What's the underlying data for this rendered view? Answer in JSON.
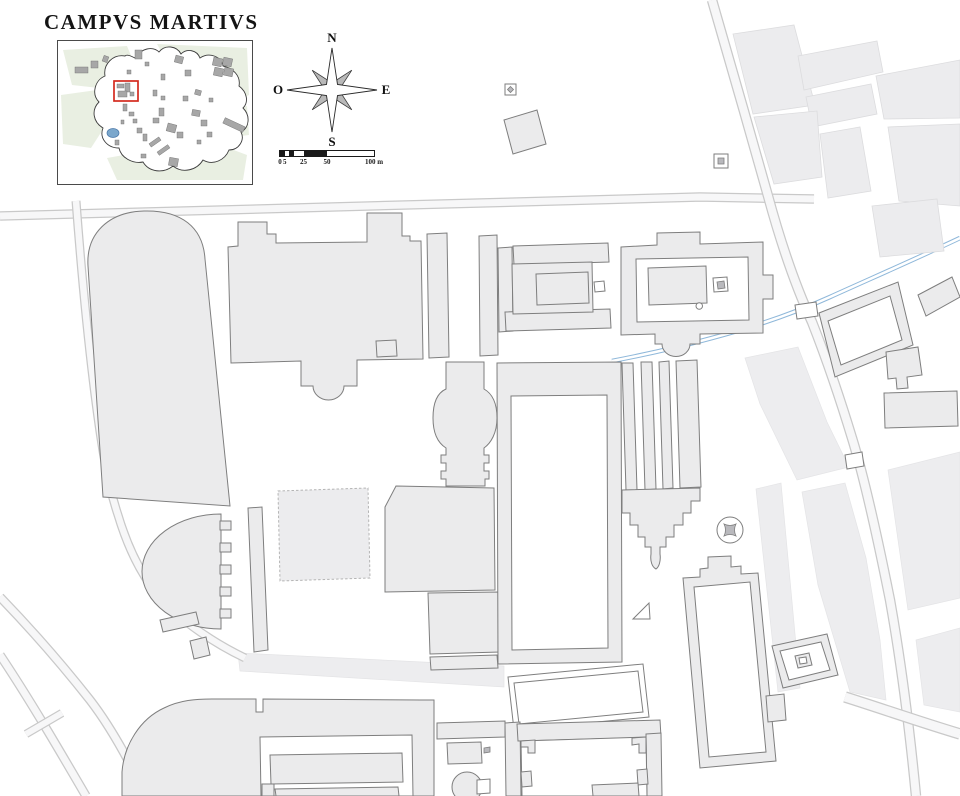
{
  "title": "CAMPVS MARTIVS",
  "compass": {
    "n": "N",
    "w": "O",
    "e": "E",
    "s": "S"
  },
  "scalebar": {
    "px_per_m": 0.94,
    "ticks": [
      {
        "m": 0,
        "t": "0"
      },
      {
        "m": 5,
        "t": "5"
      },
      {
        "m": 25,
        "t": "25"
      },
      {
        "m": 50,
        "t": "50"
      },
      {
        "m": 100,
        "t": "100 m"
      }
    ],
    "segments": [
      {
        "a": 0,
        "b": 5,
        "dark": true
      },
      {
        "a": 5,
        "b": 10,
        "dark": false
      },
      {
        "a": 10,
        "b": 15,
        "dark": true
      },
      {
        "a": 15,
        "b": 25,
        "dark": false
      },
      {
        "a": 25,
        "b": 50,
        "dark": true
      },
      {
        "a": 50,
        "b": 100,
        "dark": false
      }
    ]
  },
  "colors": {
    "ink": "#1a1a1a",
    "building_fill": "#ebebec",
    "building_stroke": "#7e7e7e",
    "block_fill": "#ececee",
    "block_stroke": "#dcdcde",
    "light_fill": "#ededef",
    "light_stroke": "#e4e4e6",
    "road_casing": "#c9c9c9",
    "road_fill": "#f7f7f8",
    "aqueduct_blue": "#8fb8da",
    "ruin_stroke": "#b4b4b4",
    "monument_gray": "#b9b9bd",
    "inset_green": "#e9efe2",
    "inset_building": "#a7a7a7",
    "inset_water": "#7ba7cc",
    "highlight_red": "#d42a1e"
  },
  "map": {
    "light": [
      {
        "n": "light-band-south-of-theater",
        "d": "M238,653 L504,666 L504,687 L240,671 Z"
      },
      {
        "n": "light-band-via-lata-south",
        "d": "M756,489 L781,483 L800,688 L778,692 Z"
      },
      {
        "n": "light-block-east-1",
        "d": "M745,358 L798,347 L827,422 L849,467 L797,480 L760,404 Z"
      },
      {
        "n": "light-block-east-2",
        "d": "M802,492 L845,483 L866,558 L880,640 L886,700 L850,692 L818,585 Z"
      },
      {
        "n": "light-block-east-3",
        "d": "M888,470 L960,452 L960,598 L908,610 Z"
      },
      {
        "n": "light-block-east-4",
        "d": "M916,640 L960,628 L960,712 L924,705 Z"
      }
    ],
    "roads": [
      {
        "n": "road-main-east-west",
        "w": 7,
        "d": "M0,216 L480,203 L700,197 L814,199"
      },
      {
        "n": "road-west-north-south",
        "w": 6.5,
        "d": "M76,201 C82,280 88,340 95,395 C102,450 108,485 118,515 C130,555 148,588 172,610 C195,630 220,646 245,658"
      },
      {
        "n": "road-southwest-a",
        "w": 7,
        "d": "M0,597 C30,628 60,662 90,700 C110,726 128,758 146,796"
      },
      {
        "n": "road-southwest-b",
        "w": 7,
        "d": "M0,655 C30,700 58,748 86,796"
      },
      {
        "n": "road-southwest-link",
        "w": 6,
        "d": "M26,734 L62,713"
      },
      {
        "n": "road-northeast-diagonal",
        "w": 8,
        "d": "M712,0 C730,62 750,132 768,196 C780,240 795,285 812,322 C825,355 838,392 852,438 C865,480 878,540 890,600 C898,645 908,712 916,796"
      },
      {
        "n": "road-southeast",
        "w": 9,
        "d": "M845,697 C880,708 920,722 960,734"
      }
    ],
    "aqueduct": {
      "n": "aqua-virgo-aqueduct",
      "d": "M960,238 C920,257 872,278 830,297 C788,316 750,328 712,338 C672,349 638,356 612,361"
    },
    "shapes": [
      {
        "n": "city-block-ne-1",
        "c": "blk",
        "d": "M733,34 L794,25 L815,105 L753,114 Z"
      },
      {
        "n": "city-block-ne-2",
        "c": "blk",
        "d": "M798,56 L877,41 L883,72 L804,90 Z"
      },
      {
        "n": "city-block-ne-3",
        "c": "blk",
        "d": "M806,97 L871,84 L877,114 L812,127 Z"
      },
      {
        "n": "city-block-ne-4",
        "c": "blk",
        "d": "M754,117 L817,111 L822,177 L774,184 Z"
      },
      {
        "n": "city-block-ne-5",
        "c": "blk",
        "d": "M820,134 L860,127 L871,191 L828,198 Z"
      },
      {
        "n": "city-block-ne-6",
        "c": "blk",
        "d": "M876,76 L960,60 L960,118 L884,119 Z"
      },
      {
        "n": "city-block-ne-7",
        "c": "blk",
        "d": "M888,127 L960,124 L960,206 L899,201 Z"
      },
      {
        "n": "city-block-ne-8",
        "c": "blk",
        "d": "M872,206 L937,199 L944,251 L880,257 Z"
      },
      {
        "n": "ruin-outline-square",
        "c": "ruin",
        "d": "M278,491 L368,488 L370,578 L280,581 Z"
      },
      {
        "n": "stadium-building",
        "c": "b",
        "d": "M103,497 L88,266 C86,234 108,212 144,211 C181,210 203,227 205,259 L230,506 Z"
      },
      {
        "n": "central-bath-complex",
        "c": "b",
        "d": "M231,363 L228,247 L238,246 L238,222 L267,222 L267,234 L276,234 L276,243 L367,242 L367,213 L402,213 L402,236 L410,236 L410,241 L421,241 L423,359 L357,360 L357,386 L344,386 A15.5,14 0 0 1 313,386 L301,386 L301,361 Z"
      },
      {
        "n": "portico-strip-west",
        "c": "b",
        "d": "M427,234 L447,233 L449,357 L429,358 Z"
      },
      {
        "n": "portico-strip-east",
        "c": "b",
        "d": "M479,236 L497,235 L498,355 L480,356 Z"
      },
      {
        "n": "rotunda-corridor-building",
        "c": "b",
        "d": "M446,362 L484,362 L484,389 C493,394 497,404 497,418 C497,433 491,443 484,448 L484,455 L489,455 L489,463 L484,463 L484,471 L489,471 L489,479 L485,479 L485,486 L446,486 L446,479 L441,479 L441,471 L446,471 L446,463 L441,463 L441,455 L446,455 L446,448 C438,443 433,433 433,418 C433,403 437,393 446,389 Z"
      },
      {
        "n": "large-square-building",
        "c": "b",
        "d": "M396,486 L494,488 L495,590 L385,592 L385,507 Z"
      },
      {
        "n": "large-square-building-south-wing",
        "c": "b",
        "d": "M428,593 L499,592 L500,652 L430,654 Z"
      },
      {
        "n": "wall-bar-below-south-wing",
        "c": "b",
        "d": "M430,657 L497,655 L498,668 L431,670 Z"
      },
      {
        "n": "theater-cavea",
        "c": "b",
        "d": "M221,514 A79,57.5 0 0 0 221,629 Z"
      },
      {
        "n": "theater-stair-tooth-1",
        "c": "b",
        "d": "M220,521 L231,521 L231,530 L220,530 Z"
      },
      {
        "n": "theater-stair-tooth-2",
        "c": "b",
        "d": "M220,543 L231,543 L231,552 L220,552 Z"
      },
      {
        "n": "theater-stair-tooth-3",
        "c": "b",
        "d": "M220,565 L231,565 L231,574 L220,574 Z"
      },
      {
        "n": "theater-stair-tooth-4",
        "c": "b",
        "d": "M220,587 L231,587 L231,596 L220,596 Z"
      },
      {
        "n": "theater-stair-tooth-5",
        "c": "b",
        "d": "M220,609 L231,609 L231,618 L220,618 Z"
      },
      {
        "n": "long-thin-portico-bar",
        "c": "b",
        "d": "M248,508 L262,507 L268,650 L254,652 Z"
      },
      {
        "n": "small-square-building",
        "c": "b",
        "d": "M376,341 L396,340 L397,356 L377,357 Z"
      },
      {
        "n": "tilted-bar-building-1",
        "c": "b",
        "d": "M160,620 L196,612 L199,624 L163,632 Z"
      },
      {
        "n": "tilted-bar-building-2",
        "c": "b",
        "d": "M190,641 L206,637 L210,655 L194,659 Z"
      },
      {
        "n": "west-precinct-left-wall",
        "c": "b",
        "d": "M498,248 L512,247 L513,331 L499,332 Z"
      },
      {
        "n": "west-precinct-top-bar",
        "c": "b",
        "d": "M513,246 L608,243 L609,262 L514,265 Z"
      },
      {
        "n": "west-precinct-bottom-bar",
        "c": "b",
        "d": "M505,312 L610,309 L611,328 L506,331 Z"
      },
      {
        "n": "west-precinct-platform",
        "c": "b",
        "d": "M512,264 L592,262 L593,312 L513,314 Z"
      },
      {
        "n": "west-temple-cella",
        "c": "b",
        "d": "M536,274 L588,272 L589,303 L537,305 Z"
      },
      {
        "n": "west-precinct-altar",
        "c": "w",
        "d": "M594,282 L604,281 L605,291 L595,292 Z"
      },
      {
        "n": "east-temple-precinct",
        "c": "b",
        "d": "M621,247 L657,245 L657,233 L700,232 L700,244 L763,242 L763,275 L773,275 L773,299 L763,299 L763,333 L700,334 L700,344 L690,344 A14,12.5 0 0 1 662,344 L655,344 L655,334 L621,335 Z"
      },
      {
        "n": "east-precinct-courtyard",
        "c": "w",
        "d": "M636,259 L748,257 L749,320 L637,322 Z"
      },
      {
        "n": "east-temple-cella",
        "c": "b",
        "d": "M648,268 L706,266 L707,303 L649,305 Z"
      },
      {
        "n": "east-precinct-altar",
        "c": "w",
        "d": "M713,278 L727,277 L728,291 L714,292 Z"
      },
      {
        "n": "east-precinct-altar-core",
        "c": "mono",
        "d": "M717,282 L724,281 L725,288 L718,289 Z"
      },
      {
        "n": "east-precinct-well",
        "c": "w",
        "d": "M696,306 A3.2,3.2 0 1 0 702.5,306 A3.2,3.2 0 1 0 696,306 Z"
      },
      {
        "n": "saepta-enclosure",
        "c": "b",
        "d": "M497,363 L621,362 L622,662 L498,664 Z"
      },
      {
        "n": "saepta-courtyard",
        "c": "w",
        "d": "M511,396 L607,395 L608,648 L512,650 Z"
      },
      {
        "n": "aqueduct-pier-strip-1",
        "c": "b",
        "d": "M622,363 L633,363 L637,490 L626,490 Z"
      },
      {
        "n": "aqueduct-pier-strip-2",
        "c": "b",
        "d": "M641,362 L652,362 L656,489 L645,490 Z"
      },
      {
        "n": "aqueduct-pier-strip-3",
        "c": "b",
        "d": "M659,362 L669,361 L673,488 L663,489 Z"
      },
      {
        "n": "aqueduct-pier-strip-4",
        "c": "b",
        "d": "M676,361 L697,360 L701,487 L680,488 Z"
      },
      {
        "n": "stepped-monument",
        "c": "b",
        "d": "M622,490 L700,488 L700,501 L691,501 L691,513 L683,513 L683,525 L674,525 L674,537 L666,537 L666,547 L660,547 L660,554 C661,561 659,567 656,569 C652,567 650,561 651,554 L651,547 L645,547 L645,537 L638,537 L638,525 L630,525 L630,513 L622,513 Z"
      },
      {
        "n": "column-monument-base",
        "c": "w",
        "d": "M717,530 A13,13 0 1 0 743,530 A13,13 0 1 0 717,530 Z"
      },
      {
        "n": "column-monument-shaft",
        "c": "mono",
        "d": "M724,524 Q730,527 736,524 Q733,530 736,536 Q730,533 724,536 Q727,530 724,524 Z"
      },
      {
        "n": "ustrinum-enclosure-south",
        "c": "b",
        "d": "M683,578 L700,577 L700,569 L708,568 L708,557 L731,556 L731,567 L741,566 L741,574 L758,573 L776,761 L700,768 Z"
      },
      {
        "n": "ustrinum-enclosure-south-court",
        "c": "w",
        "d": "M694,587 L750,582 L766,752 L709,757 Z"
      },
      {
        "n": "ustrinum-enclosure-tab",
        "c": "b",
        "d": "M766,696 L784,694 L786,720 L768,722 Z"
      },
      {
        "n": "small-tilted-enclosure",
        "c": "b",
        "d": "M772,646 L827,634 L838,675 L783,688 Z"
      },
      {
        "n": "small-tilted-enclosure-court",
        "c": "w",
        "d": "M780,651 L821,642 L830,670 L789,680 Z"
      },
      {
        "n": "small-tilted-enclosure-altar",
        "c": "b",
        "d": "M795,656 L809,653 L812,665 L798,668 Z"
      },
      {
        "n": "small-tilted-enclosure-altar-core",
        "c": "w",
        "d": "M799,658 L806,657 L807,663 L800,664 Z"
      },
      {
        "n": "ustrinum-enclosure-east",
        "c": "b",
        "d": "M819,313 L898,282 L913,345 L835,377 Z"
      },
      {
        "n": "ustrinum-enclosure-east-court",
        "c": "w",
        "d": "M828,321 L890,296 L902,340 L841,365 Z"
      },
      {
        "n": "tilted-building-far-east",
        "c": "b",
        "d": "M918,295 L952,277 L960,297 L926,316 Z"
      },
      {
        "n": "notched-building-east",
        "c": "b",
        "d": "M886,352 L918,347 L922,375 L907,377 L908,388 L897,389 L896,378 L888,379 Z"
      },
      {
        "n": "long-building-east",
        "c": "b",
        "d": "M884,393 L957,391 L958,426 L885,428 Z"
      },
      {
        "n": "triangle-monument",
        "c": "w",
        "d": "M633,619 L649,603 L650,619 Z"
      },
      {
        "n": "tilted-court-enclosure",
        "c": "w",
        "d": "M508,677 L643,664 L649,717 L514,730 Z"
      },
      {
        "n": "tilted-court-enclosure-inner",
        "c": "w",
        "d": "M514,683 L638,671 L643,712 L519,724 Z"
      },
      {
        "n": "baths-complex",
        "c": "b",
        "d": "M122,772 C124,745 140,719 164,708 C180,700 196,699 212,699 L256,699 L256,712 L263,712 L263,699 L421,700 L434,700 L434,796 L122,796 Z"
      },
      {
        "n": "baths-courtyard",
        "c": "w",
        "d": "M260,737 L412,735 L413,796 L261,796 Z"
      },
      {
        "n": "baths-hall-1",
        "c": "b",
        "d": "M270,755 L402,753 L403,782 L271,784 Z"
      },
      {
        "n": "baths-hall-2",
        "c": "b",
        "d": "M275,789 L398,787 L399,796 L276,796 Z"
      },
      {
        "n": "baths-room-small",
        "c": "b",
        "d": "M262,784 L274,784 L274,796 L262,796 Z"
      },
      {
        "n": "south-enclosure-west-topbar",
        "c": "b",
        "d": "M437,723 L505,721 L505,737 L437,739 Z"
      },
      {
        "n": "south-enclosure-west-room",
        "c": "b",
        "d": "M447,743 L481,742 L482,763 L448,764 Z"
      },
      {
        "n": "south-enclosure-west-rotunda",
        "c": "b",
        "d": "M452,787 A15,15 0 1 0 482,787 A15,15 0 1 0 452,787 Z"
      },
      {
        "n": "south-enclosure-west-rotunda-notch",
        "c": "w",
        "d": "M477,780 L490,779 L490,793 L477,794 Z"
      },
      {
        "n": "small-dash-mark",
        "c": "mono",
        "d": "M484,748 L490,747 L490,752 L484,753 Z"
      },
      {
        "n": "south-enclosure-left-wall",
        "c": "b",
        "d": "M505,723 L520,722 L521,796 L506,796 Z"
      },
      {
        "n": "south-enclosure-top-wall",
        "c": "b",
        "d": "M517,724 L660,720 L661,737 L518,741 Z"
      },
      {
        "n": "south-enclosure-right-wall",
        "c": "b",
        "d": "M646,734 L661,733 L662,796 L647,796 Z"
      },
      {
        "n": "south-enclosure-courtyard",
        "c": "w",
        "d": "M521,741 L646,737 L647,796 L522,796 Z"
      },
      {
        "n": "south-enclosure-notch-nw",
        "c": "b",
        "d": "M521,741 L535,740 L535,753 L528,753 L528,747 L521,747 Z"
      },
      {
        "n": "south-enclosure-notch-ne",
        "c": "b",
        "d": "M632,738 L646,737 L646,753 L639,753 L639,744 L632,745 Z"
      },
      {
        "n": "south-enclosure-tab-w",
        "c": "b",
        "d": "M521,772 L531,771 L532,786 L522,787 Z"
      },
      {
        "n": "south-enclosure-tab-e",
        "c": "b",
        "d": "M637,770 L647,769 L648,784 L638,785 Z"
      },
      {
        "n": "south-enclosure-room",
        "c": "b",
        "d": "M592,785 L638,783 L639,796 L593,796 Z"
      },
      {
        "n": "small-marker-monument-nw",
        "c": "w",
        "d": "M505,84 L516,84 L516,95 L505,95 Z"
      },
      {
        "n": "small-marker-monument-nw-core",
        "c": "mono",
        "d": "M510.5,86.5 L513.5,89.5 L510.5,92.5 L507.5,89.5 Z"
      },
      {
        "n": "small-marker-monument-ne",
        "c": "w",
        "d": "M714,154 L728,154 L728,168 L714,168 Z"
      },
      {
        "n": "small-marker-monument-ne-core",
        "c": "mono",
        "d": "M718,158 L724,158 L724,164 L718,164 Z"
      },
      {
        "n": "tilted-square-monument",
        "c": "b",
        "d": "M504,120 L537,110 L546,144 L513,154 Z"
      },
      {
        "n": "road-gate-north",
        "c": "w",
        "d": "M795,305 L816,302 L818,316 L797,319 Z"
      },
      {
        "n": "road-gate-south",
        "c": "w",
        "d": "M845,455 L862,452 L864,466 L847,469 Z"
      }
    ]
  },
  "inset": {
    "outline_d": "M78,18 C84,8 96,6 102,12 C108,4 120,6 124,14 C130,8 140,10 143,18 C152,12 164,16 166,26 C176,28 184,36 182,46 C190,52 192,62 186,68 C194,76 192,88 184,92 C188,100 182,110 172,110 C168,120 156,126 146,120 C140,130 126,134 116,126 C106,134 92,132 86,122 C76,124 64,118 62,108 C50,108 42,98 46,88 C36,82 34,70 42,62 C34,54 38,40 48,36 C46,24 56,14 68,16 C70,14 74,16 78,18 Z",
    "green_patches": [
      "M6,10 L70,6 L80,30 L60,50 L15,45 Z",
      "M100,4 L190,8 L192,55 L160,70 L120,40 Z",
      "M4,55 L40,50 L52,80 L34,108 L6,104 Z",
      "M50,118 L150,100 L190,115 L186,140 L60,140 Z",
      "M160,70 L190,66 L192,95 L168,98 Z"
    ],
    "buildings": [
      [
        18,
        27,
        13,
        6,
        0
      ],
      [
        34,
        21,
        7,
        7,
        0
      ],
      [
        46,
        16,
        5,
        6,
        20
      ],
      [
        70,
        30,
        4,
        4,
        0
      ],
      [
        78,
        10,
        7,
        9,
        0
      ],
      [
        88,
        22,
        4,
        4,
        0
      ],
      [
        118,
        16,
        8,
        7,
        15
      ],
      [
        128,
        30,
        6,
        6,
        0
      ],
      [
        156,
        18,
        9,
        8,
        12
      ],
      [
        166,
        18,
        9,
        8,
        12
      ],
      [
        157,
        28,
        9,
        8,
        12
      ],
      [
        167,
        28,
        9,
        8,
        12
      ],
      [
        104,
        34,
        4,
        6,
        0
      ],
      [
        96,
        50,
        4,
        6,
        0
      ],
      [
        104,
        56,
        4,
        4,
        0
      ],
      [
        126,
        56,
        5,
        5,
        0
      ],
      [
        138,
        50,
        6,
        5,
        15
      ],
      [
        152,
        58,
        4,
        4,
        0
      ],
      [
        60,
        44,
        7,
        4,
        0
      ],
      [
        68,
        43,
        5,
        9,
        0
      ],
      [
        61,
        51,
        9,
        6,
        0
      ],
      [
        73,
        52,
        4,
        4,
        0
      ],
      [
        66,
        64,
        4,
        7,
        0
      ],
      [
        72,
        72,
        5,
        4,
        0
      ],
      [
        76,
        79,
        4,
        4,
        0
      ],
      [
        64,
        80,
        3,
        4,
        0
      ],
      [
        80,
        88,
        5,
        5,
        0
      ],
      [
        86,
        94,
        4,
        7,
        0
      ],
      [
        92,
        100,
        12,
        4,
        -35
      ],
      [
        100,
        108,
        13,
        4,
        -35
      ],
      [
        112,
        118,
        9,
        8,
        10
      ],
      [
        96,
        78,
        6,
        5,
        0
      ],
      [
        102,
        68,
        5,
        8,
        0
      ],
      [
        110,
        84,
        9,
        8,
        15
      ],
      [
        120,
        92,
        6,
        6,
        0
      ],
      [
        135,
        70,
        8,
        6,
        10
      ],
      [
        144,
        80,
        6,
        6,
        0
      ],
      [
        150,
        92,
        5,
        5,
        0
      ],
      [
        140,
        100,
        4,
        4,
        0
      ],
      [
        58,
        100,
        4,
        5,
        0
      ],
      [
        84,
        114,
        5,
        4,
        0
      ],
      [
        166,
        82,
        22,
        6,
        25
      ]
    ],
    "water": {
      "cx": 56,
      "cy": 93,
      "rx": 6,
      "ry": 4.5
    },
    "highlight": {
      "x": 57,
      "y": 41,
      "w": 24,
      "h": 20
    }
  }
}
